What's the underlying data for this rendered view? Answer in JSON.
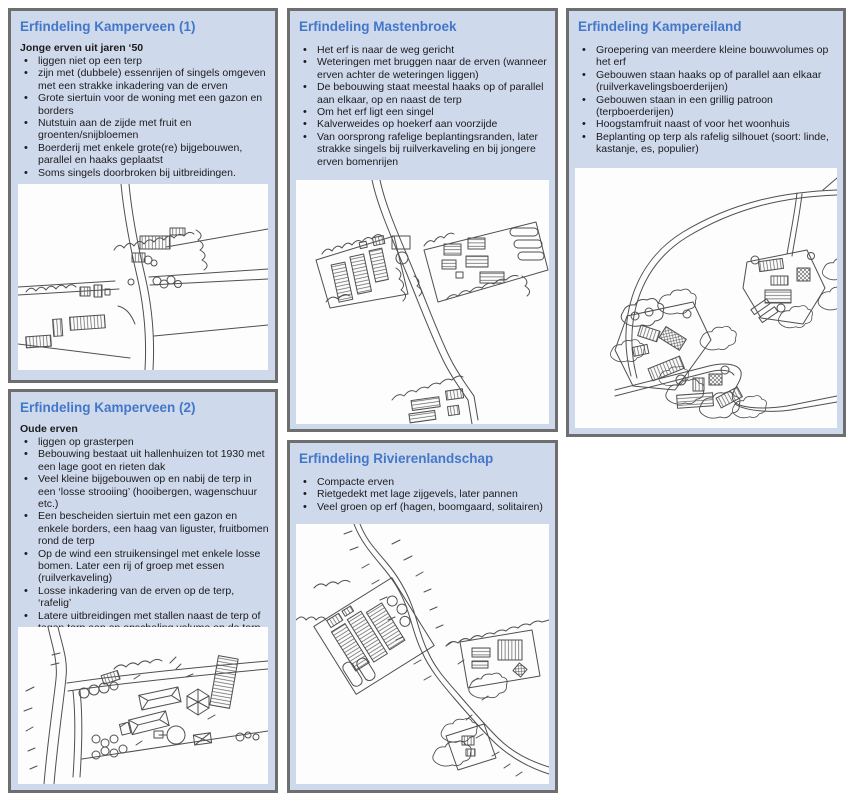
{
  "theme": {
    "panel_bg": "#cfd9ec",
    "panel_border": "#6e6e6e",
    "title_color": "#4377c9",
    "text_color": "#1b1b1b",
    "sketch_bg": "#fdfdfd",
    "sketch_stroke": "#4f4f4f"
  },
  "panels": [
    {
      "id": "kamperveen-1",
      "title": "Erfindeling Kamperveen (1)",
      "subtitle": "Jonge erven uit jaren ‘50",
      "bullets": [
        "liggen niet op een terp",
        "zijn met (dubbele) essenrijen of singels omgeven met een strakke inkadering van de erven",
        "Grote siertuin voor de woning met een gazon en borders",
        "Nutstuin aan de zijde met fruit en groenten/snijbloemen",
        "Boerderij met enkele grote(re) bijgebouwen, parallel en haaks geplaatst",
        "Soms singels doorbroken bij uitbreidingen."
      ]
    },
    {
      "id": "mastenbroek",
      "title": "Erfindeling Mastenbroek",
      "bullets": [
        "Het erf is naar de weg gericht",
        "Weteringen met bruggen naar de erven (wanneer erven achter de weteringen liggen)",
        "De bebouwing staat meestal haaks op of parallel aan elkaar, op en naast de terp",
        "Om het erf ligt een singel",
        "Kalverweides op hoekerf aan voorzijde",
        "Van oorsprong rafelige beplantingsranden, later strakke singels bij ruilverkaveling en bij jongere erven bomenrijen"
      ]
    },
    {
      "id": "kampereiland",
      "title": "Erfindeling Kampereiland",
      "bullets": [
        "Groepering van meerdere kleine bouwvolumes op het erf",
        "Gebouwen staan haaks op of parallel aan elkaar (ruilverkavelingsboerderijen)",
        "Gebouwen staan in een grillig patroon (terpboerderijen)",
        "Hoogstamfruit naast of voor het woonhuis",
        "Beplanting op terp als rafelig silhouet (soort: linde, kastanje, es, populier)"
      ]
    },
    {
      "id": "kamperveen-2",
      "title": "Erfindeling Kamperveen (2)",
      "subtitle": "Oude erven",
      "bullets": [
        "liggen op grasterpen",
        "Bebouwing bestaat uit hallenhuizen tot 1930 met een lage goot en rieten dak",
        "Veel kleine bijgebouwen op en nabij de terp in een ‘losse strooiing’ (hooibergen, wagenschuur etc.)",
        "Een bescheiden siertuin met een gazon en enkele borders, een haag van liguster, fruitbomen rond de terp",
        "Op de wind een struikensingel met enkele losse bomen. Later een rij of groep met essen (ruilverkaveling)",
        "Losse inkadering van de erven op de terp, ‘rafelig’",
        "Latere uitbreidingen met stallen naast de terp of tegen terp aan en opschaling volume op de terp."
      ]
    },
    {
      "id": "rivierenlandschap",
      "title": "Erfindeling Rivierenlandschap",
      "bullets": [
        "Compacte erven",
        "Rietgedekt met lage zijgevels, later pannen",
        "Veel groen op erf (hagen, boomgaard, solitairen)"
      ]
    }
  ]
}
